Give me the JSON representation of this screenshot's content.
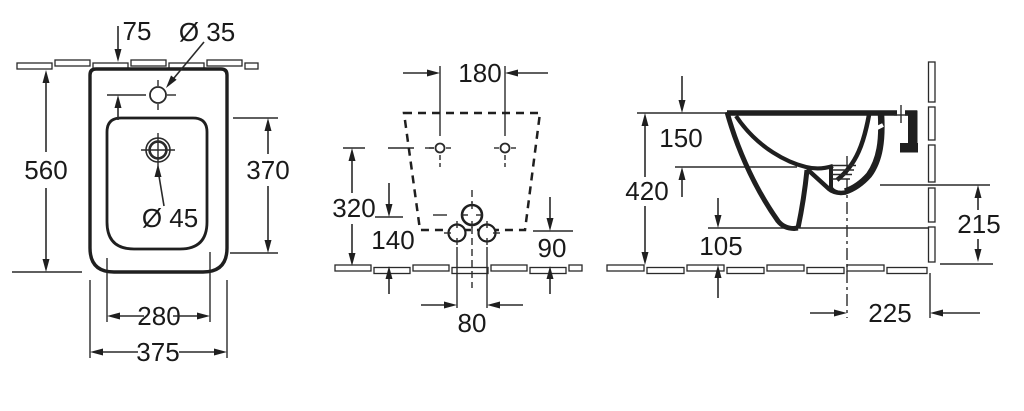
{
  "title": "Wall-hung bidet technical drawing, three views",
  "colors": {
    "background": "#ffffff",
    "line": "#2a2a2a",
    "text": "#1a1a1a"
  },
  "views": {
    "top": {
      "name": "top view",
      "dims": {
        "wall_to_taphole": "75",
        "taphole_diameter": "Ø 35",
        "total_depth": "560",
        "basin_length": "370",
        "drain_diameter": "Ø 45",
        "basin_width": "280",
        "total_width": "375"
      }
    },
    "front": {
      "name": "front view",
      "dims": {
        "mounting_holes_spacing": "180",
        "mounting_holes_height": "320",
        "drain_height": "140",
        "body_bottom_height": "90",
        "fixing_bolts_spacing": "80"
      }
    },
    "side": {
      "name": "side view",
      "dims": {
        "rim_to_mounting_holes": "150",
        "rim_height": "420",
        "underside_clearance": "105",
        "wall_outlet_height": "215",
        "drain_axis_to_wall": "225"
      }
    }
  }
}
